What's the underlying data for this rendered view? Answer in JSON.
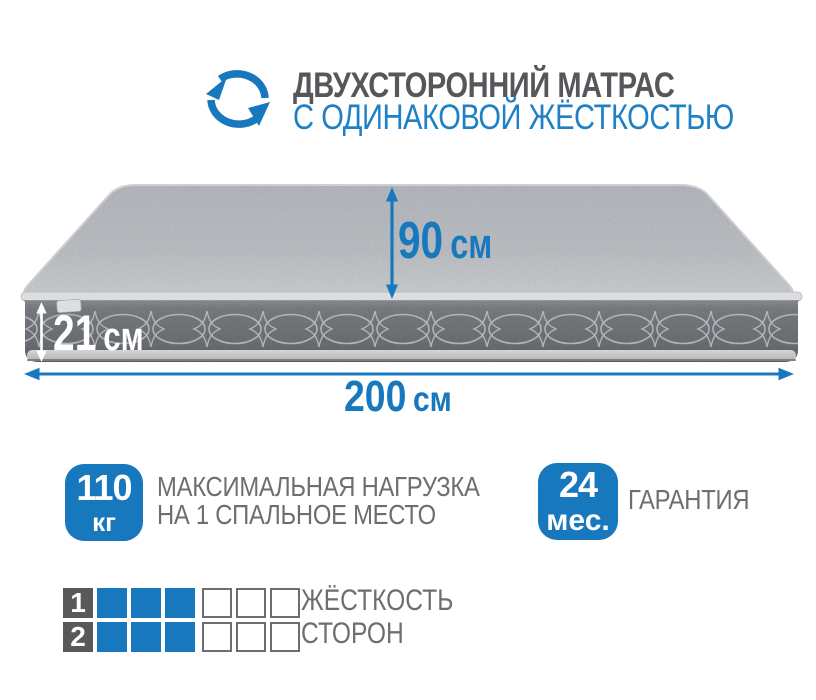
{
  "header": {
    "title": "ДВУХСТОРОННИЙ МАТРАС",
    "subtitle": "С ОДИНАКОВОЙ ЖЁСТКОСТЬЮ",
    "icon": "rotate-arrows-icon"
  },
  "dimensions": {
    "depth": {
      "value": "90",
      "unit": "см"
    },
    "height": {
      "value": "21",
      "unit": "см"
    },
    "width": {
      "value": "200",
      "unit": "см"
    }
  },
  "features": {
    "max_load": {
      "value": "110",
      "unit": "кг",
      "label_line1": "МАКСИМАЛЬНАЯ НАГРУЗКА",
      "label_line2": "НА 1 СПАЛЬНОЕ МЕСТО"
    },
    "warranty": {
      "value": "24",
      "unit": "мес.",
      "label": "ГАРАНТИЯ"
    }
  },
  "hardness": {
    "label_line1": "ЖЁСТКОСТЬ",
    "label_line2": "СТОРОН",
    "scale_max": 6,
    "rows": [
      {
        "side": "1",
        "filled": 3
      },
      {
        "side": "2",
        "filled": 3
      }
    ]
  },
  "colors": {
    "accent_blue": "#1878be",
    "subtitle_blue": "#1e81c5",
    "title_gray": "#56575a",
    "label_gray": "#6d6e70",
    "square_dark": "#58595b",
    "square_border": "#6d6e70"
  }
}
